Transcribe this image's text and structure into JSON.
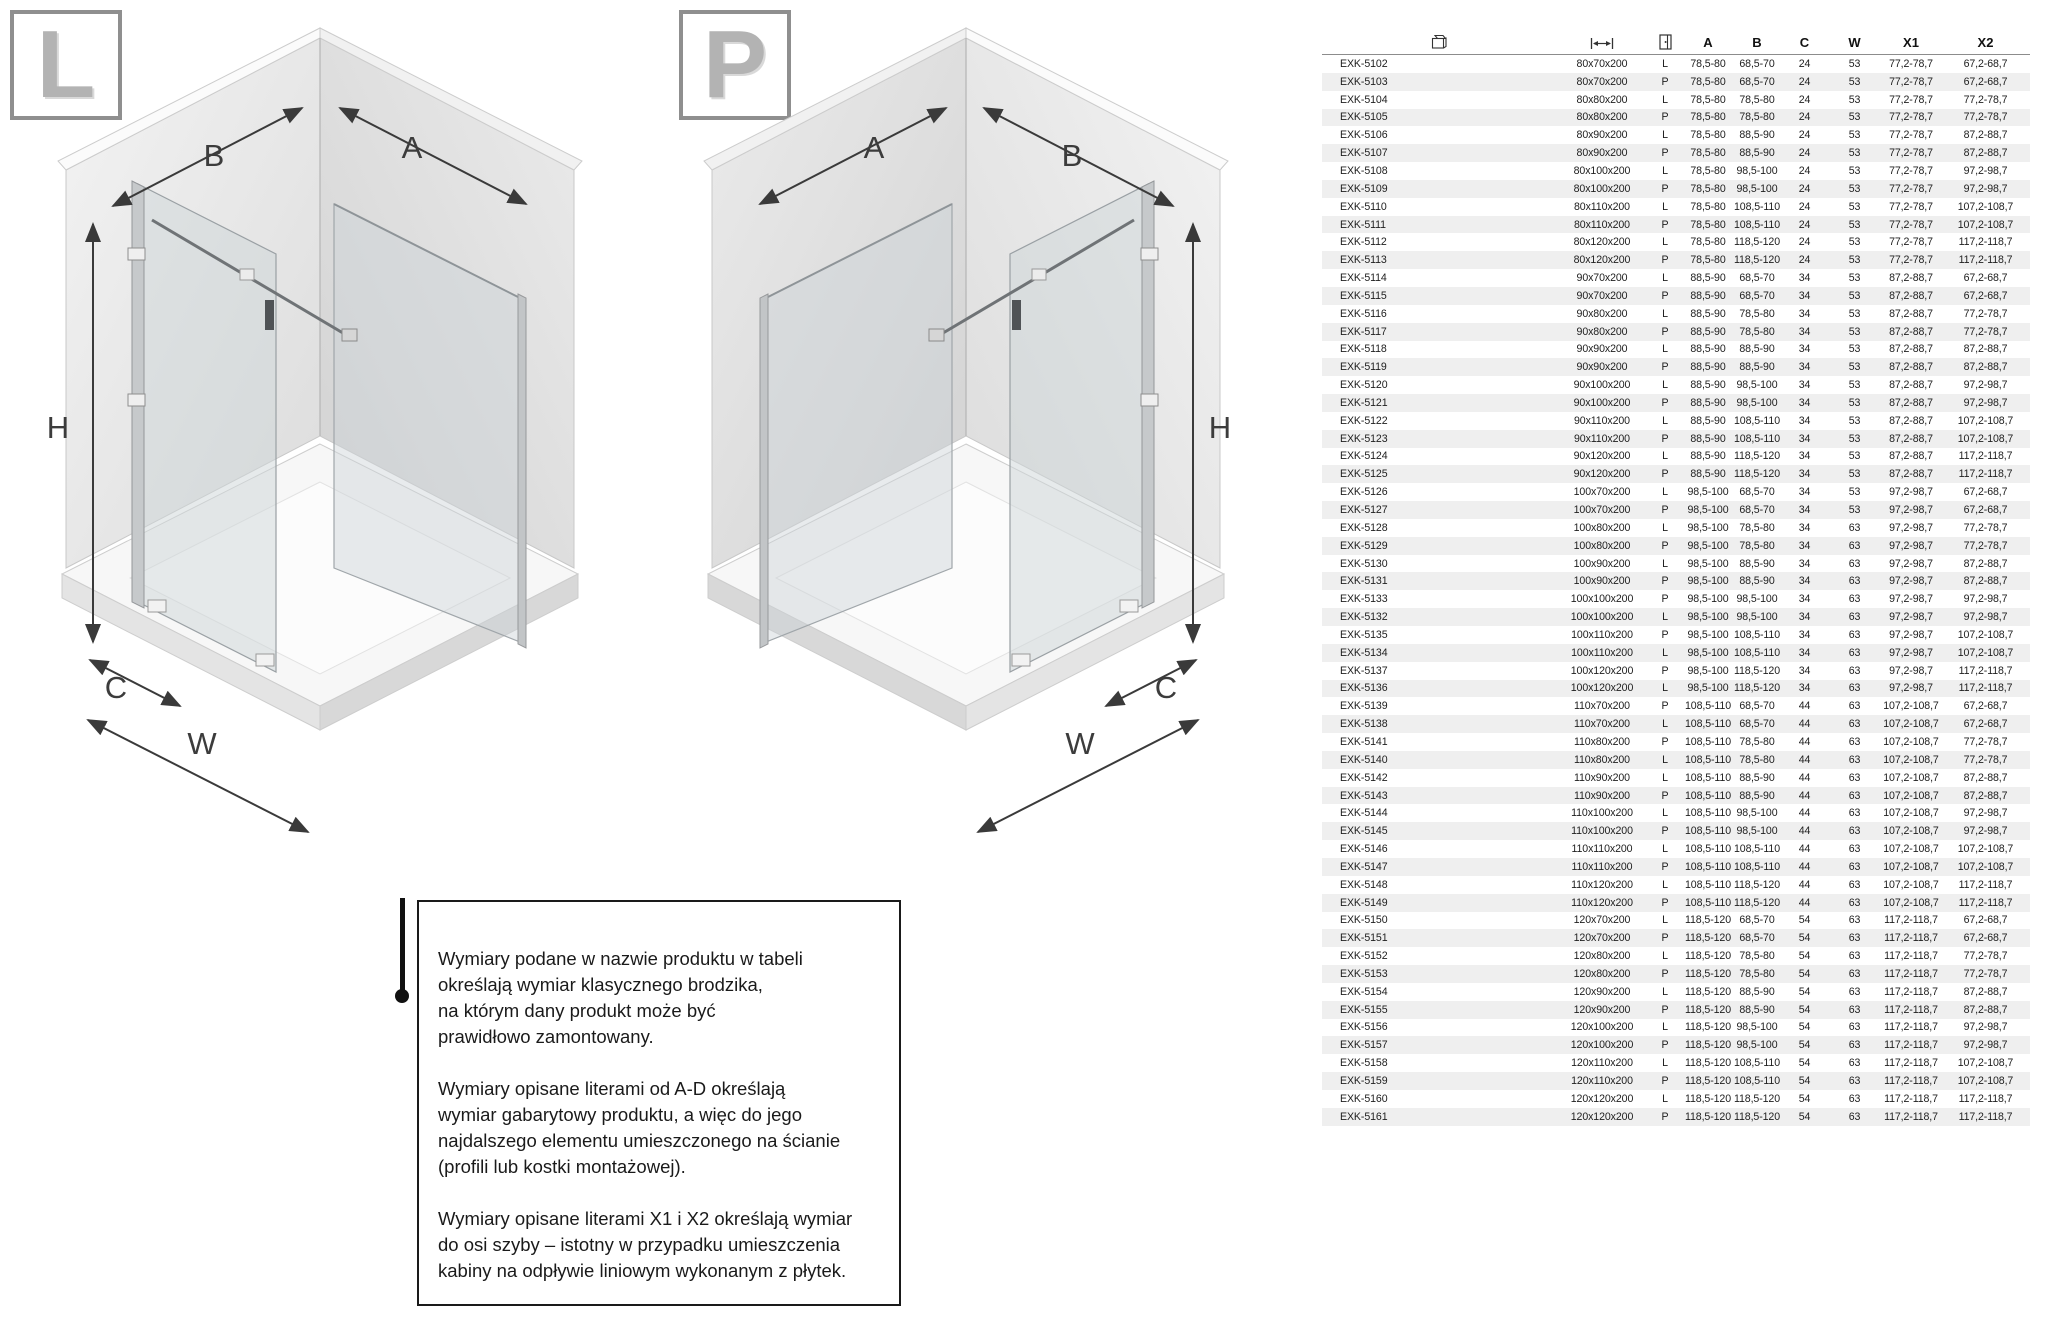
{
  "badges": {
    "left": "L",
    "right": "P"
  },
  "diagrams": {
    "left": {
      "top_left_label": "B",
      "top_right_label": "A",
      "height_label": "H",
      "depth_label": "C",
      "width_label": "W"
    },
    "right": {
      "top_left_label": "A",
      "top_right_label": "B",
      "height_label": "H",
      "depth_label": "C",
      "width_label": "W"
    }
  },
  "info_box": {
    "paragraphs": [
      [
        "Wymiary podane w nazwie produktu w tabeli",
        "określają wymiar klasycznego brodzika,",
        "na którym dany produkt może być",
        "prawidłowo zamontowany."
      ],
      [
        "Wymiary opisane literami od A-D określają",
        "wymiar gabarytowy produktu, a więc do jego",
        "najdalszego elementu umieszczonego na ścianie",
        "(profili lub kostki montażowej)."
      ],
      [
        "Wymiary opisane literami X1 i X2 określają wymiar",
        "do osi szyby – istotny w przypadku umieszczenia",
        "kabiny na odpływie liniowym wykonanym z płytek."
      ]
    ]
  },
  "table": {
    "icon_headers": [
      "product-box-icon",
      "dimensions-icon",
      "door-side-icon"
    ],
    "text_headers": [
      "A",
      "B",
      "C",
      "W",
      "X1",
      "X2"
    ],
    "rows": [
      [
        "EXK-5102",
        "80x70x200",
        "L",
        "78,5-80",
        "68,5-70",
        "24",
        "53",
        "77,2-78,7",
        "67,2-68,7"
      ],
      [
        "EXK-5103",
        "80x70x200",
        "P",
        "78,5-80",
        "68,5-70",
        "24",
        "53",
        "77,2-78,7",
        "67,2-68,7"
      ],
      [
        "EXK-5104",
        "80x80x200",
        "L",
        "78,5-80",
        "78,5-80",
        "24",
        "53",
        "77,2-78,7",
        "77,2-78,7"
      ],
      [
        "EXK-5105",
        "80x80x200",
        "P",
        "78,5-80",
        "78,5-80",
        "24",
        "53",
        "77,2-78,7",
        "77,2-78,7"
      ],
      [
        "EXK-5106",
        "80x90x200",
        "L",
        "78,5-80",
        "88,5-90",
        "24",
        "53",
        "77,2-78,7",
        "87,2-88,7"
      ],
      [
        "EXK-5107",
        "80x90x200",
        "P",
        "78,5-80",
        "88,5-90",
        "24",
        "53",
        "77,2-78,7",
        "87,2-88,7"
      ],
      [
        "EXK-5108",
        "80x100x200",
        "L",
        "78,5-80",
        "98,5-100",
        "24",
        "53",
        "77,2-78,7",
        "97,2-98,7"
      ],
      [
        "EXK-5109",
        "80x100x200",
        "P",
        "78,5-80",
        "98,5-100",
        "24",
        "53",
        "77,2-78,7",
        "97,2-98,7"
      ],
      [
        "EXK-5110",
        "80x110x200",
        "L",
        "78,5-80",
        "108,5-110",
        "24",
        "53",
        "77,2-78,7",
        "107,2-108,7"
      ],
      [
        "EXK-5111",
        "80x110x200",
        "P",
        "78,5-80",
        "108,5-110",
        "24",
        "53",
        "77,2-78,7",
        "107,2-108,7"
      ],
      [
        "EXK-5112",
        "80x120x200",
        "L",
        "78,5-80",
        "118,5-120",
        "24",
        "53",
        "77,2-78,7",
        "117,2-118,7"
      ],
      [
        "EXK-5113",
        "80x120x200",
        "P",
        "78,5-80",
        "118,5-120",
        "24",
        "53",
        "77,2-78,7",
        "117,2-118,7"
      ],
      [
        "EXK-5114",
        "90x70x200",
        "L",
        "88,5-90",
        "68,5-70",
        "34",
        "53",
        "87,2-88,7",
        "67,2-68,7"
      ],
      [
        "EXK-5115",
        "90x70x200",
        "P",
        "88,5-90",
        "68,5-70",
        "34",
        "53",
        "87,2-88,7",
        "67,2-68,7"
      ],
      [
        "EXK-5116",
        "90x80x200",
        "L",
        "88,5-90",
        "78,5-80",
        "34",
        "53",
        "87,2-88,7",
        "77,2-78,7"
      ],
      [
        "EXK-5117",
        "90x80x200",
        "P",
        "88,5-90",
        "78,5-80",
        "34",
        "53",
        "87,2-88,7",
        "77,2-78,7"
      ],
      [
        "EXK-5118",
        "90x90x200",
        "L",
        "88,5-90",
        "88,5-90",
        "34",
        "53",
        "87,2-88,7",
        "87,2-88,7"
      ],
      [
        "EXK-5119",
        "90x90x200",
        "P",
        "88,5-90",
        "88,5-90",
        "34",
        "53",
        "87,2-88,7",
        "87,2-88,7"
      ],
      [
        "EXK-5120",
        "90x100x200",
        "L",
        "88,5-90",
        "98,5-100",
        "34",
        "53",
        "87,2-88,7",
        "97,2-98,7"
      ],
      [
        "EXK-5121",
        "90x100x200",
        "P",
        "88,5-90",
        "98,5-100",
        "34",
        "53",
        "87,2-88,7",
        "97,2-98,7"
      ],
      [
        "EXK-5122",
        "90x110x200",
        "L",
        "88,5-90",
        "108,5-110",
        "34",
        "53",
        "87,2-88,7",
        "107,2-108,7"
      ],
      [
        "EXK-5123",
        "90x110x200",
        "P",
        "88,5-90",
        "108,5-110",
        "34",
        "53",
        "87,2-88,7",
        "107,2-108,7"
      ],
      [
        "EXK-5124",
        "90x120x200",
        "L",
        "88,5-90",
        "118,5-120",
        "34",
        "53",
        "87,2-88,7",
        "117,2-118,7"
      ],
      [
        "EXK-5125",
        "90x120x200",
        "P",
        "88,5-90",
        "118,5-120",
        "34",
        "53",
        "87,2-88,7",
        "117,2-118,7"
      ],
      [
        "EXK-5126",
        "100x70x200",
        "L",
        "98,5-100",
        "68,5-70",
        "34",
        "53",
        "97,2-98,7",
        "67,2-68,7"
      ],
      [
        "EXK-5127",
        "100x70x200",
        "P",
        "98,5-100",
        "68,5-70",
        "34",
        "53",
        "97,2-98,7",
        "67,2-68,7"
      ],
      [
        "EXK-5128",
        "100x80x200",
        "L",
        "98,5-100",
        "78,5-80",
        "34",
        "63",
        "97,2-98,7",
        "77,2-78,7"
      ],
      [
        "EXK-5129",
        "100x80x200",
        "P",
        "98,5-100",
        "78,5-80",
        "34",
        "63",
        "97,2-98,7",
        "77,2-78,7"
      ],
      [
        "EXK-5130",
        "100x90x200",
        "L",
        "98,5-100",
        "88,5-90",
        "34",
        "63",
        "97,2-98,7",
        "87,2-88,7"
      ],
      [
        "EXK-5131",
        "100x90x200",
        "P",
        "98,5-100",
        "88,5-90",
        "34",
        "63",
        "97,2-98,7",
        "87,2-88,7"
      ],
      [
        "EXK-5133",
        "100x100x200",
        "P",
        "98,5-100",
        "98,5-100",
        "34",
        "63",
        "97,2-98,7",
        "97,2-98,7"
      ],
      [
        "EXK-5132",
        "100x100x200",
        "L",
        "98,5-100",
        "98,5-100",
        "34",
        "63",
        "97,2-98,7",
        "97,2-98,7"
      ],
      [
        "EXK-5135",
        "100x110x200",
        "P",
        "98,5-100",
        "108,5-110",
        "34",
        "63",
        "97,2-98,7",
        "107,2-108,7"
      ],
      [
        "EXK-5134",
        "100x110x200",
        "L",
        "98,5-100",
        "108,5-110",
        "34",
        "63",
        "97,2-98,7",
        "107,2-108,7"
      ],
      [
        "EXK-5137",
        "100x120x200",
        "P",
        "98,5-100",
        "118,5-120",
        "34",
        "63",
        "97,2-98,7",
        "117,2-118,7"
      ],
      [
        "EXK-5136",
        "100x120x200",
        "L",
        "98,5-100",
        "118,5-120",
        "34",
        "63",
        "97,2-98,7",
        "117,2-118,7"
      ],
      [
        "EXK-5139",
        "110x70x200",
        "P",
        "108,5-110",
        "68,5-70",
        "44",
        "63",
        "107,2-108,7",
        "67,2-68,7"
      ],
      [
        "EXK-5138",
        "110x70x200",
        "L",
        "108,5-110",
        "68,5-70",
        "44",
        "63",
        "107,2-108,7",
        "67,2-68,7"
      ],
      [
        "EXK-5141",
        "110x80x200",
        "P",
        "108,5-110",
        "78,5-80",
        "44",
        "63",
        "107,2-108,7",
        "77,2-78,7"
      ],
      [
        "EXK-5140",
        "110x80x200",
        "L",
        "108,5-110",
        "78,5-80",
        "44",
        "63",
        "107,2-108,7",
        "77,2-78,7"
      ],
      [
        "EXK-5142",
        "110x90x200",
        "L",
        "108,5-110",
        "88,5-90",
        "44",
        "63",
        "107,2-108,7",
        "87,2-88,7"
      ],
      [
        "EXK-5143",
        "110x90x200",
        "P",
        "108,5-110",
        "88,5-90",
        "44",
        "63",
        "107,2-108,7",
        "87,2-88,7"
      ],
      [
        "EXK-5144",
        "110x100x200",
        "L",
        "108,5-110",
        "98,5-100",
        "44",
        "63",
        "107,2-108,7",
        "97,2-98,7"
      ],
      [
        "EXK-5145",
        "110x100x200",
        "P",
        "108,5-110",
        "98,5-100",
        "44",
        "63",
        "107,2-108,7",
        "97,2-98,7"
      ],
      [
        "EXK-5146",
        "110x110x200",
        "L",
        "108,5-110",
        "108,5-110",
        "44",
        "63",
        "107,2-108,7",
        "107,2-108,7"
      ],
      [
        "EXK-5147",
        "110x110x200",
        "P",
        "108,5-110",
        "108,5-110",
        "44",
        "63",
        "107,2-108,7",
        "107,2-108,7"
      ],
      [
        "EXK-5148",
        "110x120x200",
        "L",
        "108,5-110",
        "118,5-120",
        "44",
        "63",
        "107,2-108,7",
        "117,2-118,7"
      ],
      [
        "EXK-5149",
        "110x120x200",
        "P",
        "108,5-110",
        "118,5-120",
        "44",
        "63",
        "107,2-108,7",
        "117,2-118,7"
      ],
      [
        "EXK-5150",
        "120x70x200",
        "L",
        "118,5-120",
        "68,5-70",
        "54",
        "63",
        "117,2-118,7",
        "67,2-68,7"
      ],
      [
        "EXK-5151",
        "120x70x200",
        "P",
        "118,5-120",
        "68,5-70",
        "54",
        "63",
        "117,2-118,7",
        "67,2-68,7"
      ],
      [
        "EXK-5152",
        "120x80x200",
        "L",
        "118,5-120",
        "78,5-80",
        "54",
        "63",
        "117,2-118,7",
        "77,2-78,7"
      ],
      [
        "EXK-5153",
        "120x80x200",
        "P",
        "118,5-120",
        "78,5-80",
        "54",
        "63",
        "117,2-118,7",
        "77,2-78,7"
      ],
      [
        "EXK-5154",
        "120x90x200",
        "L",
        "118,5-120",
        "88,5-90",
        "54",
        "63",
        "117,2-118,7",
        "87,2-88,7"
      ],
      [
        "EXK-5155",
        "120x90x200",
        "P",
        "118,5-120",
        "88,5-90",
        "54",
        "63",
        "117,2-118,7",
        "87,2-88,7"
      ],
      [
        "EXK-5156",
        "120x100x200",
        "L",
        "118,5-120",
        "98,5-100",
        "54",
        "63",
        "117,2-118,7",
        "97,2-98,7"
      ],
      [
        "EXK-5157",
        "120x100x200",
        "P",
        "118,5-120",
        "98,5-100",
        "54",
        "63",
        "117,2-118,7",
        "97,2-98,7"
      ],
      [
        "EXK-5158",
        "120x110x200",
        "L",
        "118,5-120",
        "108,5-110",
        "54",
        "63",
        "117,2-118,7",
        "107,2-108,7"
      ],
      [
        "EXK-5159",
        "120x110x200",
        "P",
        "118,5-120",
        "108,5-110",
        "54",
        "63",
        "117,2-118,7",
        "107,2-108,7"
      ],
      [
        "EXK-5160",
        "120x120x200",
        "L",
        "118,5-120",
        "118,5-120",
        "54",
        "63",
        "117,2-118,7",
        "117,2-118,7"
      ],
      [
        "EXK-5161",
        "120x120x200",
        "P",
        "118,5-120",
        "118,5-120",
        "54",
        "63",
        "117,2-118,7",
        "117,2-118,7"
      ]
    ]
  }
}
